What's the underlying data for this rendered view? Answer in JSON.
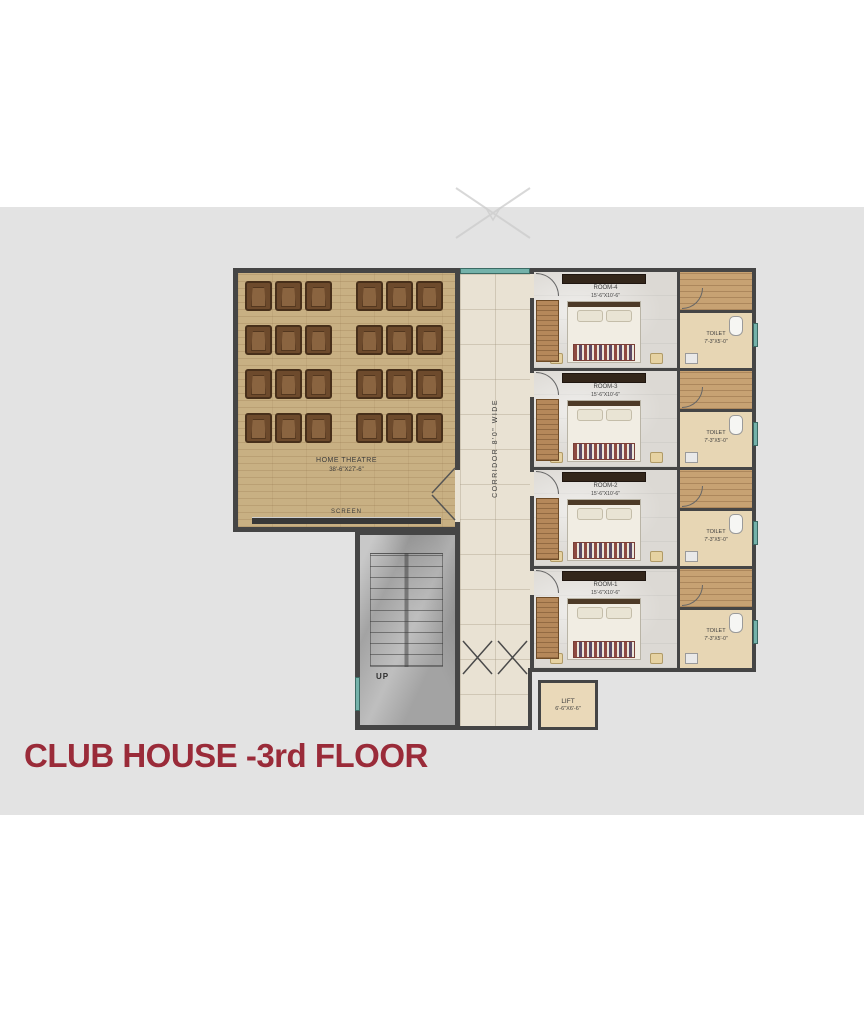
{
  "page": {
    "title_label": "CLUB HOUSE -3rd FLOOR"
  },
  "colors": {
    "title": "#9a2b39",
    "band": "#e3e3e3",
    "wall": "#454545",
    "window_teal": "#74b2aa",
    "theatre_wood": "#c8b083",
    "corridor_marble": "#e9e2d3",
    "toilet_floor": "#e7d6b4"
  },
  "theatre": {
    "name": "HOME THEATRE",
    "dims": "38'-6\"X27'-6\"",
    "screen_label": "SCREEN",
    "seat_rows": 4,
    "seats_per_row": 6
  },
  "corridor": {
    "label": "CORRIDOR 8'0\" WIDE"
  },
  "rooms": [
    {
      "name": "ROOM-4",
      "dims": "15'-6\"X10'-6\"",
      "toilet": {
        "name": "TOILET",
        "dims": "7'-3\"X5'-0\""
      }
    },
    {
      "name": "ROOM-3",
      "dims": "15'-6\"X10'-6\"",
      "toilet": {
        "name": "TOILET",
        "dims": "7'-3\"X5'-0\""
      }
    },
    {
      "name": "ROOM-2",
      "dims": "15'-6\"X10'-6\"",
      "toilet": {
        "name": "TOILET",
        "dims": "7'-3\"X5'-0\""
      }
    },
    {
      "name": "ROOM-1",
      "dims": "15'-6\"X10'-6\"",
      "toilet": {
        "name": "TOILET",
        "dims": "7'-3\"X5'-0\""
      }
    }
  ],
  "stairs": {
    "label": "UP"
  },
  "lift": {
    "name": "LIFT",
    "dims": "6'-6\"X6'-6\""
  }
}
